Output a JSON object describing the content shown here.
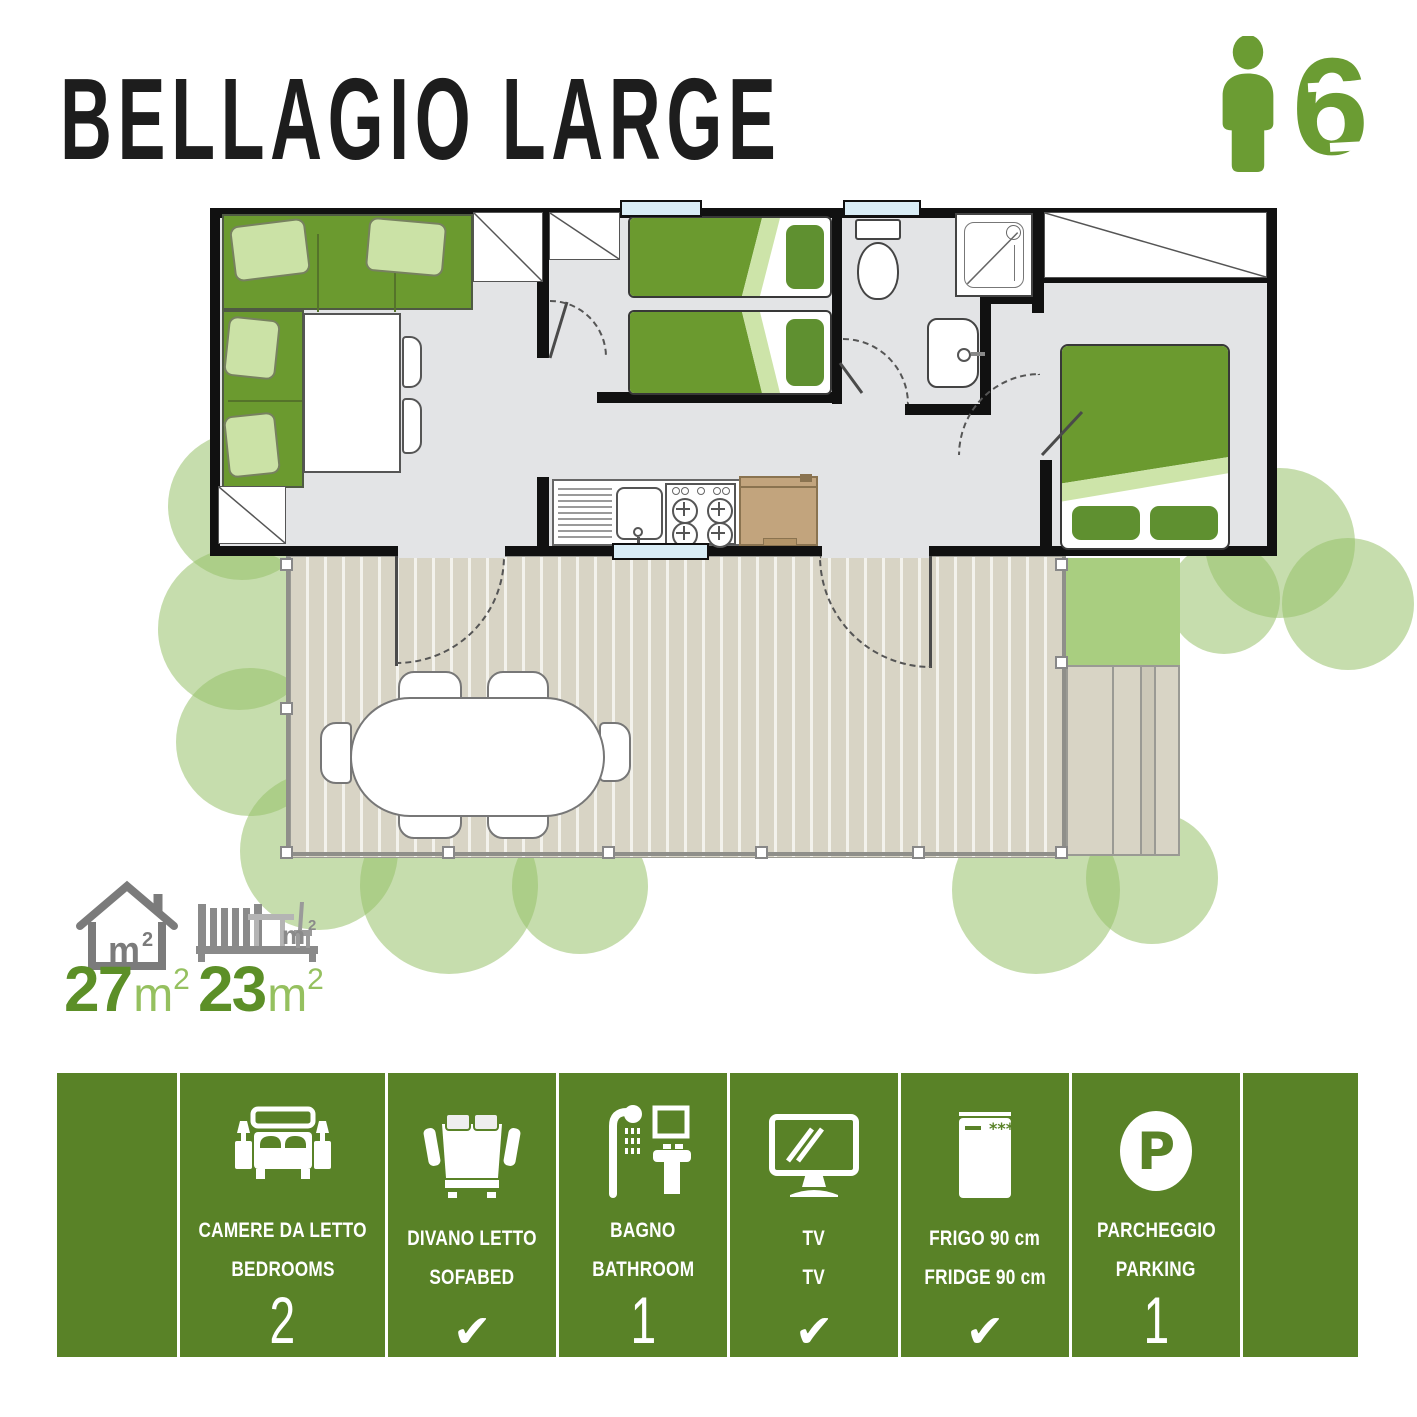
{
  "title": "BELLAGIO LARGE",
  "capacity": {
    "value": "6",
    "icon": "person-icon",
    "color": "#6b9c33"
  },
  "areas": {
    "interior": {
      "value": "27",
      "unit": "m",
      "sup": "2",
      "icon": "house-icon"
    },
    "terrace": {
      "value": "23",
      "unit": "m",
      "sup": "2",
      "icon": "deck-bench-icon"
    }
  },
  "colors": {
    "footer_green": "#598227",
    "accent_green": "#6b9c33",
    "furniture_green": "#6b9a2f",
    "cushion_green": "#cbe2a6",
    "tree_green": "#97be6a",
    "floor_gray": "#e3e4e6",
    "deck_tan": "#d8d4c5",
    "window_blue": "#d9edf6",
    "counter_tan": "#c2a47d"
  },
  "amenities": [
    {
      "id": "empty-left",
      "icon": "",
      "label_it": "",
      "label_en": "",
      "value": ""
    },
    {
      "id": "bedrooms",
      "icon": "bed-icon",
      "label_it": "CAMERE DA LETTO",
      "label_en": "BEDROOMS",
      "value": "2"
    },
    {
      "id": "sofabed",
      "icon": "sofabed-icon",
      "label_it": "DIVANO LETTO",
      "label_en": "SOFABED",
      "value": "✔"
    },
    {
      "id": "bathroom",
      "icon": "bathroom-icon",
      "label_it": "BAGNO",
      "label_en": "BATHROOM",
      "value": "1"
    },
    {
      "id": "tv",
      "icon": "tv-icon",
      "label_it": "TV",
      "label_en": "TV",
      "value": "✔"
    },
    {
      "id": "fridge",
      "icon": "fridge-icon",
      "label_it": "FRIGO 90 cm",
      "label_en": "FRIDGE 90 cm",
      "value": "✔"
    },
    {
      "id": "parking",
      "icon": "parking-icon",
      "label_it": "PARCHEGGIO",
      "label_en": "PARKING",
      "value": "1"
    },
    {
      "id": "empty-right",
      "icon": "",
      "label_it": "",
      "label_en": "",
      "value": ""
    }
  ]
}
